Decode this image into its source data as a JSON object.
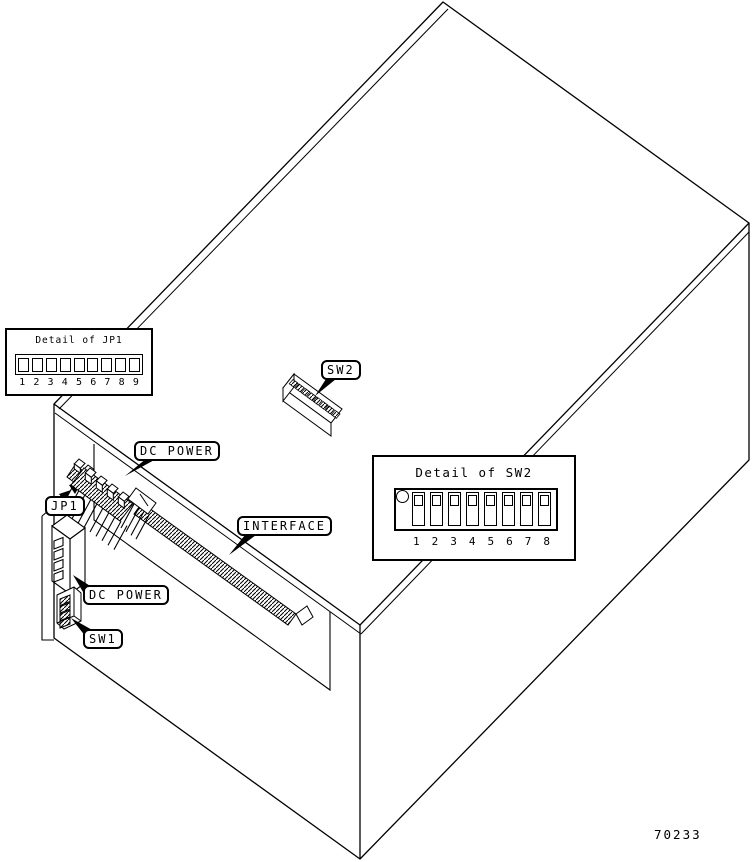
{
  "figure_number": "70233",
  "callouts": {
    "sw2": "SW2",
    "dc_power_top": "DC POWER",
    "jp1": "JP1",
    "interface": "INTERFACE",
    "dc_power_side": "DC POWER",
    "sw1": "SW1"
  },
  "detail_jp1": {
    "title": "Detail of JP1",
    "pins": [
      "1",
      "2",
      "3",
      "4",
      "5",
      "6",
      "7",
      "8",
      "9"
    ]
  },
  "detail_sw2": {
    "title": "Detail of SW2",
    "positions": [
      "1",
      "2",
      "3",
      "4",
      "5",
      "6",
      "7",
      "8"
    ]
  }
}
